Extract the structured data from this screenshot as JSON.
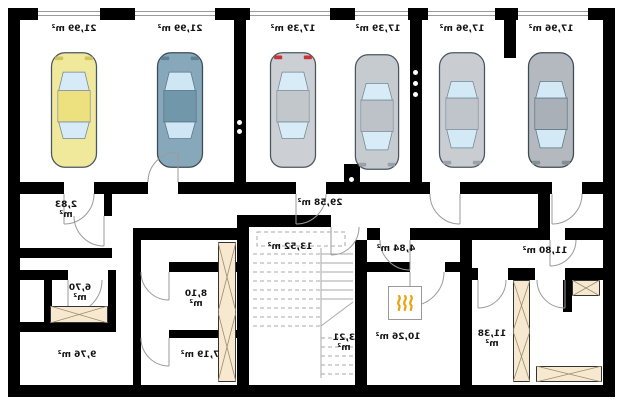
{
  "plan_type": "basement garage floor plan",
  "labels_mirrored": true,
  "unit": "m²",
  "colors": {
    "wall": "#000000",
    "door_arc": "#9a9a9a",
    "stair_line": "#aaaaaa",
    "furniture_fill": "#f6e9cf",
    "furniture_line": "#9b8c6e",
    "flame": "#e9a312",
    "label_text": "#141414"
  },
  "garage_bays": [
    {
      "label": "21,99 m²",
      "car": {
        "body": "#f0e89a",
        "roof": "#ece07f",
        "window": "#d6eaf8",
        "accent": "#cfc45e"
      }
    },
    {
      "label": "21,99 m²",
      "car": {
        "body": "#86a8ba",
        "roof": "#7097aa",
        "window": "#cfe6f4",
        "accent": "#5d8296"
      }
    },
    {
      "label": "17,39 m²",
      "car": {
        "body": "#ccd0d4",
        "roof": "#c2c7cc",
        "window": "#d8ecf8",
        "accent": "#cc3333"
      }
    },
    {
      "label": "17,39 m²",
      "car": {
        "body": "#c6cbd0",
        "roof": "#bdc2c8",
        "window": "#d8ecf8",
        "accent": "#9aa0a6"
      }
    },
    {
      "label": "17,96 m²",
      "car": {
        "body": "#c9cdd2",
        "roof": "#bfc5cb",
        "window": "#d4e9f6",
        "accent": "#9aa0a6"
      }
    },
    {
      "label": "17,96 m²",
      "car": {
        "body": "#b4b9bf",
        "roof": "#aab0b7",
        "window": "#d4e9f6",
        "accent": "#878d94"
      }
    }
  ],
  "rooms": [
    {
      "name": "hall",
      "label": "29,58 m²"
    },
    {
      "name": "small-room",
      "label": "2,83 m²",
      "line1": "2,83",
      "line2": "m²"
    },
    {
      "name": "stair-room",
      "label": "13,52 m²"
    },
    {
      "name": "vestibule",
      "label": "4,84 m²"
    },
    {
      "name": "room-right-top",
      "label": "11,80 m²"
    },
    {
      "name": "room-left-mid",
      "label": "6,70 m²",
      "line1": "6,70",
      "line2": "m²"
    },
    {
      "name": "room-mid",
      "label": "8,10 m²",
      "line1": "8,10",
      "line2": "m²"
    },
    {
      "name": "stair-landing",
      "label": "3,21 m²",
      "line1": "3,21",
      "line2": "m²"
    },
    {
      "name": "boiler-room",
      "label": "10,26 m²"
    },
    {
      "name": "room-right-bottom",
      "label": "11,38 m²",
      "line1": "11,38",
      "line2": "m²"
    },
    {
      "name": "room-left-bottom",
      "label": "9,76 m²"
    },
    {
      "name": "room-bottom-mid",
      "label": "7,19 m²"
    }
  ],
  "symbols": {
    "boiler": "flame-symbol"
  }
}
